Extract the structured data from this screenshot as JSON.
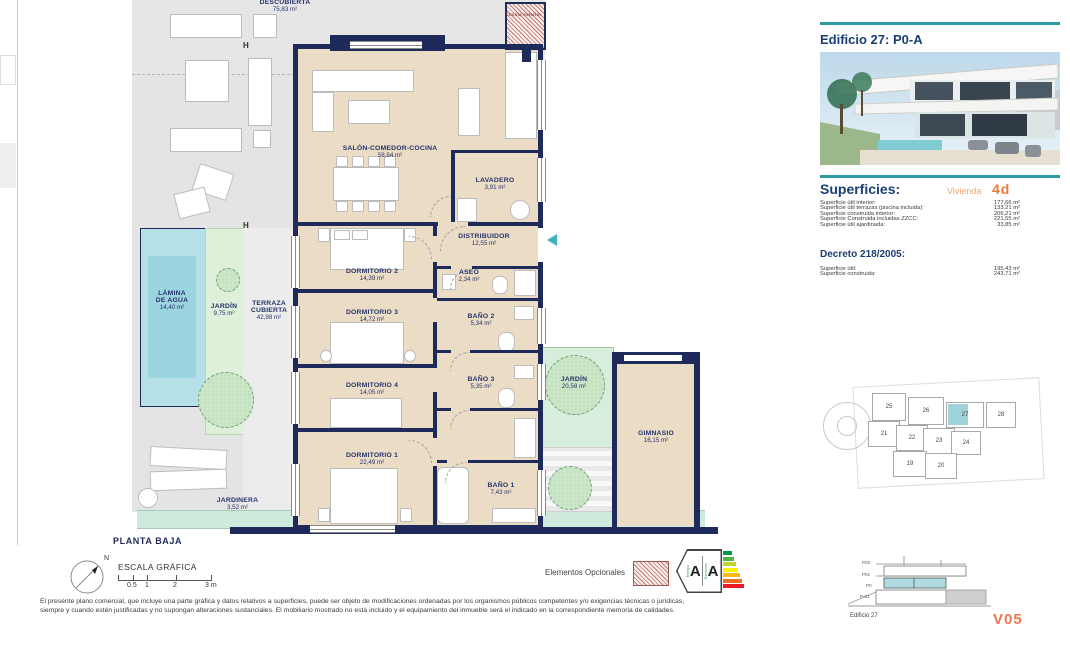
{
  "colors": {
    "accent_teal": "#2c9aa3",
    "wall_navy": "#1e2a5a",
    "label_navy": "#26346b",
    "interior_beige": "#ebdcc6",
    "pool_blue": "#a9dbe4",
    "garden_green": "#ddeed7",
    "orange_code": "#ed7833",
    "orange_light": "#f0a47c",
    "version_orange": "#f0764f",
    "site_highlight": "#9fd2da",
    "energy_scale": [
      "#009a44",
      "#4cb648",
      "#bfd730",
      "#fff200",
      "#fdb913",
      "#f37021",
      "#ed1c24"
    ]
  },
  "plan": {
    "floor_label": "PLANTA BAJA",
    "h_marker": "H",
    "rooms": {
      "terraza_descubierta": {
        "name": "DESCUBIERTA",
        "area": "75,83 m²"
      },
      "salon": {
        "name": "SALÓN-COMEDOR-COCINA",
        "area": "58,94 m²"
      },
      "lavadero": {
        "name": "LAVADERO",
        "area": "3,91 m²"
      },
      "distribuidor": {
        "name": "DISTRIBUIDOR",
        "area": "12,55 m²"
      },
      "dormitorio2": {
        "name": "DORMITORIO 2",
        "area": "14,39 m²"
      },
      "aseo": {
        "name": "ASEO",
        "area": "2,34 m²"
      },
      "dormitorio3": {
        "name": "DORMITORIO 3",
        "area": "14,72 m²"
      },
      "bano2": {
        "name": "BAÑO 2",
        "area": "5,34 m²"
      },
      "dormitorio4": {
        "name": "DORMITORIO 4",
        "area": "14,05 m²"
      },
      "bano3": {
        "name": "BAÑO 3",
        "area": "5,35 m²"
      },
      "dormitorio1": {
        "name": "DORMITORIO 1",
        "area": "22,49 m²"
      },
      "bano1": {
        "name": "BAÑO 1",
        "area": "7,43 m²"
      },
      "jardin_patio": {
        "name": "JARDÍN",
        "area": "20,58 m²"
      },
      "gimnasio": {
        "name": "GIMNASIO",
        "area": "16,15 m²"
      },
      "lamina_agua": {
        "name": "LÁMINA DE AGUA",
        "area": "14,40 m²"
      },
      "jardin_lateral": {
        "name": "JARDÍN",
        "area": "9,75 m²"
      },
      "terraza_cubierta": {
        "name": "TERRAZA CUBIERTA",
        "area": "42,98 m²"
      },
      "jardinera": {
        "name": "JARDINERA",
        "area": "3,52 m²"
      },
      "cocina_exterior": {
        "name": "Cocina exterior"
      }
    }
  },
  "sidebar": {
    "title": "Edificio 27: P0-A",
    "superficies": {
      "heading": "Superficies:",
      "vivienda_label": "Vivienda",
      "vivienda_code": "4d",
      "rows": [
        {
          "label": "Superficie útil interior:",
          "value": "177,66 m²"
        },
        {
          "label": "Superficie útil terrazas (piscina incluida):",
          "value": "133,21 m²"
        },
        {
          "label": "Superficie construida interior:",
          "value": "206,21 m²"
        },
        {
          "label": "Superficie Construida incluidas ZZCC:",
          "value": "221,55 m²"
        },
        {
          "label": "Superficie útil ajardinada:",
          "value": "33,85 m²"
        }
      ]
    },
    "decreto": {
      "heading": "Decreto 218/2005:",
      "rows": [
        {
          "label": "Superficie útil:",
          "value": "195,43 m²"
        },
        {
          "label": "Superficie construida:",
          "value": "243,71 m²"
        }
      ]
    },
    "siteplan": {
      "blocks": [
        {
          "num": "25"
        },
        {
          "num": "26"
        },
        {
          "num": "27"
        },
        {
          "num": "28"
        },
        {
          "num": "21"
        },
        {
          "num": "22"
        },
        {
          "num": "23"
        },
        {
          "num": "24"
        },
        {
          "num": "19"
        },
        {
          "num": "20"
        }
      ],
      "highlighted": "27"
    },
    "elevation": {
      "levels": [
        "P02",
        "P01",
        "P0",
        "P-01"
      ],
      "caption": "Edificio 27"
    }
  },
  "footer": {
    "scale": {
      "label": "ESCALA GRÁFICA",
      "north": "N",
      "ticks": [
        "0.5",
        "1",
        "2",
        "3 m"
      ]
    },
    "legend": {
      "optional_label": "Elementos Opcionales"
    },
    "energy": {
      "letters": [
        "A",
        "A"
      ],
      "left_text": "Energía",
      "right_text": "Emisiones"
    },
    "disclaimer_line1": "El presente plano comercial, que incluye una parte gráfica y datos relativos a superficies, puede ser objeto de modificaciones ordenadas por los organismos públicos competentes y/o exigencias técnicas o jurídicas,",
    "disclaimer_line2": "siempre y cuando estén justificadas y no supongan alteraciones sustanciales. El mobiliario mostrado no está incluido y el equipamiento del inmueble será el indicado en la correspondiente memoria de calidades.",
    "version": "V05"
  }
}
